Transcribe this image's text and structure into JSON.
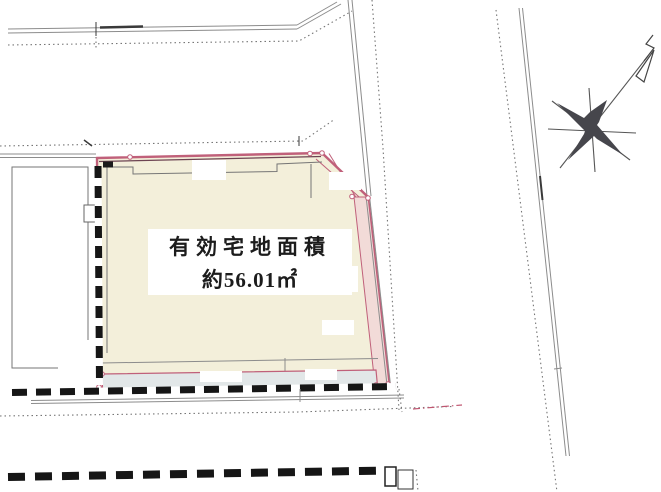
{
  "parcel_label": {
    "line1": "有効宅地面積",
    "line2": "約56.01㎡",
    "area_value": "56.01",
    "area_unit": "㎡"
  },
  "icons": {
    "north_arrow": "north-arrow-icon"
  },
  "colors": {
    "background": "#ffffff",
    "parcel_fill": "#f3efda",
    "parcel_outline": "#c0607a",
    "parcel_inner_line": "#6d4452",
    "right_strip_fill": "#f2dbd8",
    "bottom_strip_fill": "#e2e7e8",
    "road_line": "#8c8c8c",
    "dark_line": "#3a3a3a",
    "building_line": "#767676",
    "dotted": "#757575",
    "fence": "#161616",
    "accent_dashdot": "#c05570",
    "compass": "#46464c",
    "text": "#1c1c1c"
  }
}
